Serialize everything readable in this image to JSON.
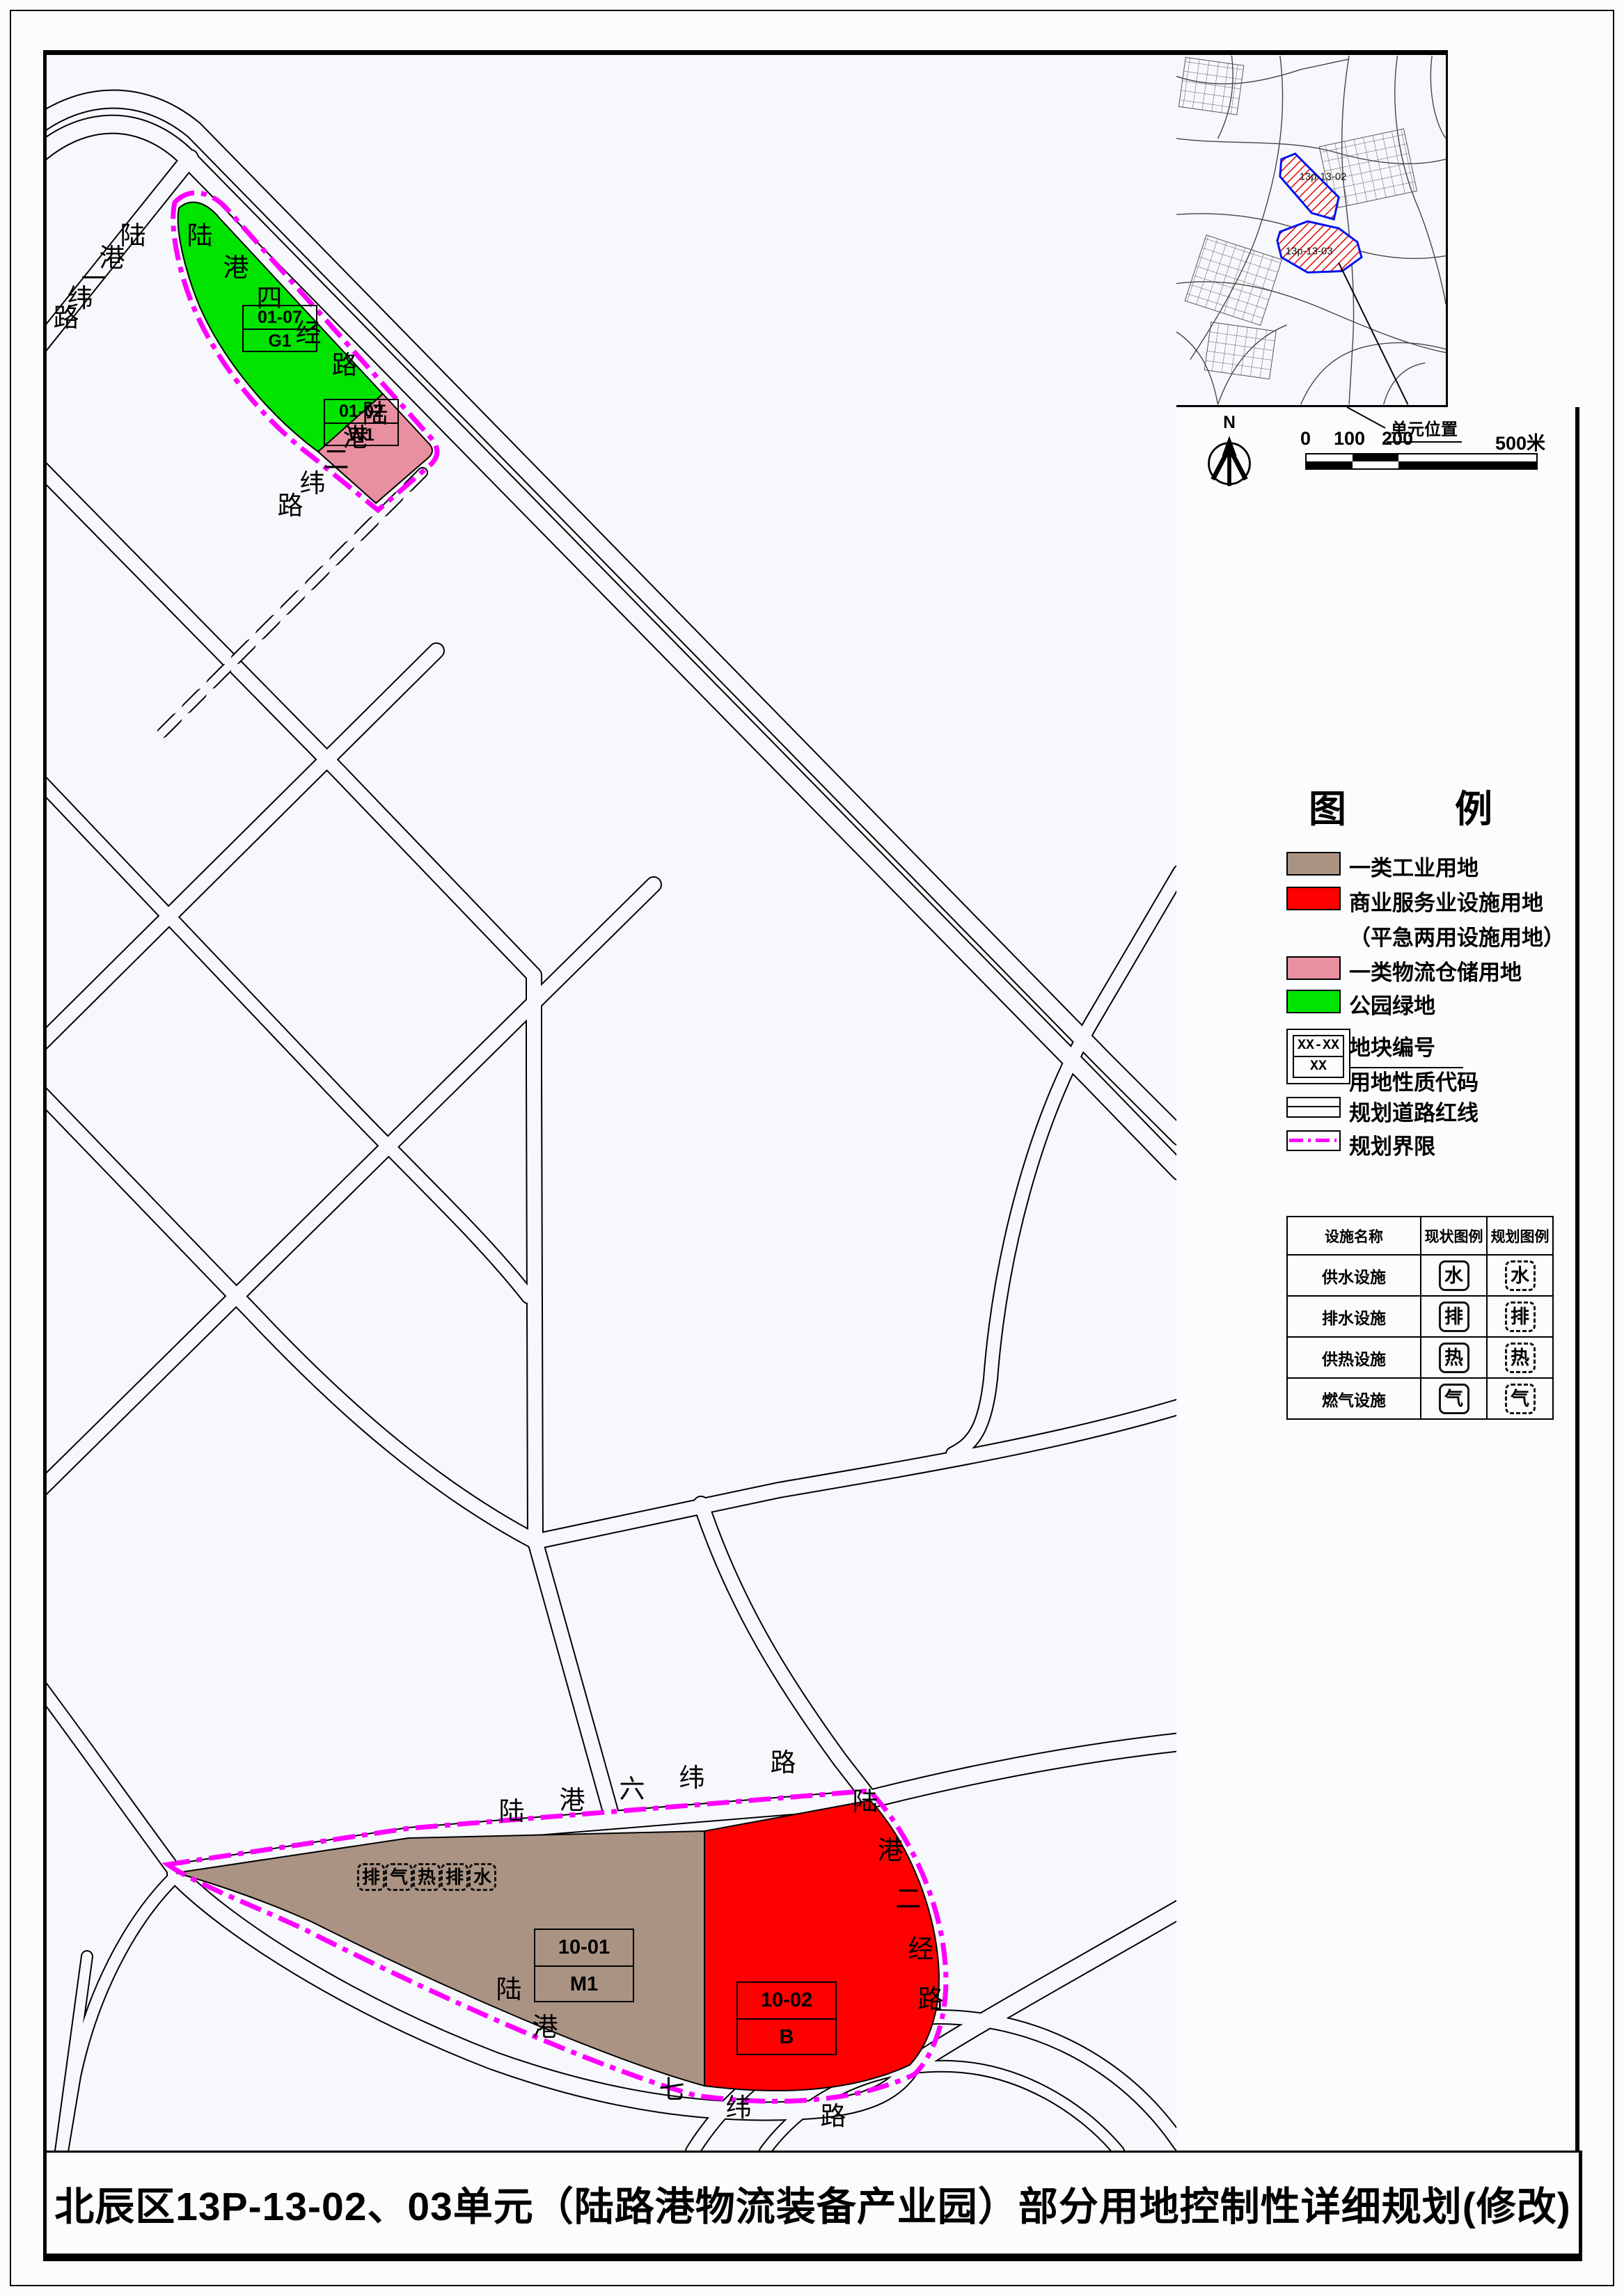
{
  "title": "北辰区13P-13-02、03单元（陆路港物流装备产业园）部分用地控制性详细规划(修改)",
  "locator": {
    "unit_labels": [
      "13p-13-02",
      "13p-13-03"
    ],
    "caption": "单元位置",
    "north_label": "N",
    "scale_ticks": [
      "0",
      "100",
      "200",
      "500米"
    ]
  },
  "legend": {
    "title_char_left": "图",
    "title_char_right": "例",
    "items": [
      {
        "label": "一类工业用地",
        "color": "#ab9384"
      },
      {
        "label": "商业服务业设施用地",
        "color": "#fe0000"
      },
      {
        "label": "（平急两用设施用地）"
      },
      {
        "label": "一类物流仓储用地",
        "color": "#e8909f"
      },
      {
        "label": "公园绿地",
        "color": "#00e400"
      },
      {
        "symbol_top": "XX-XX",
        "symbol_bottom": "XX",
        "label_top": "地块编号",
        "label_bottom": "用地性质代码"
      },
      {
        "label": "规划道路红线"
      },
      {
        "label": "规划界限",
        "color": "#ff00ff"
      }
    ]
  },
  "facility_table": {
    "headers": [
      "设施名称",
      "现状图例",
      "规划图例"
    ],
    "rows": [
      {
        "name": "供水设施",
        "glyph": "水"
      },
      {
        "name": "排水设施",
        "glyph": "排"
      },
      {
        "name": "供热设施",
        "glyph": "热"
      },
      {
        "name": "燃气设施",
        "glyph": "气"
      }
    ]
  },
  "map": {
    "parcels": [
      {
        "code": "01-07",
        "use": "G1",
        "color": "#00e400"
      },
      {
        "code": "01-02",
        "use": "W1",
        "color": "#e8909f"
      },
      {
        "code": "10-01",
        "use": "M1",
        "color": "#ab9384"
      },
      {
        "code": "10-02",
        "use": "B",
        "color": "#fe0000"
      }
    ],
    "facility_icons": [
      "排",
      "气",
      "热",
      "排",
      "水"
    ],
    "road_labels": [
      {
        "text": "陆港一纬路",
        "positions": [
          [
            104,
            240
          ],
          [
            74,
            272
          ],
          [
            48,
            302
          ],
          [
            28,
            330
          ],
          [
            8,
            358
          ]
        ]
      },
      {
        "text": "陆港四经路",
        "positions": [
          [
            200,
            240
          ],
          [
            252,
            286
          ],
          [
            300,
            330
          ],
          [
            356,
            380
          ],
          [
            408,
            426
          ]
        ]
      },
      {
        "text": "陆港二纬路",
        "positions": [
          [
            452,
            496
          ],
          [
            424,
            530
          ],
          [
            396,
            562
          ],
          [
            362,
            596
          ],
          [
            330,
            628
          ]
        ]
      },
      {
        "text": "陆港六纬路",
        "positions": [
          [
            648,
            2504
          ],
          [
            735,
            2488
          ],
          [
            821,
            2472
          ],
          [
            907,
            2456
          ],
          [
            1038,
            2434
          ]
        ]
      },
      {
        "text": "陆港七纬路",
        "positions": [
          [
            644,
            2760
          ],
          [
            696,
            2814
          ],
          [
            878,
            2904
          ],
          [
            974,
            2930
          ],
          [
            1110,
            2942
          ]
        ]
      },
      {
        "text": "陆港二经路",
        "positions": [
          [
            1156,
            2490
          ],
          [
            1192,
            2560
          ],
          [
            1218,
            2630
          ],
          [
            1236,
            2702
          ],
          [
            1250,
            2774
          ]
        ]
      }
    ]
  }
}
